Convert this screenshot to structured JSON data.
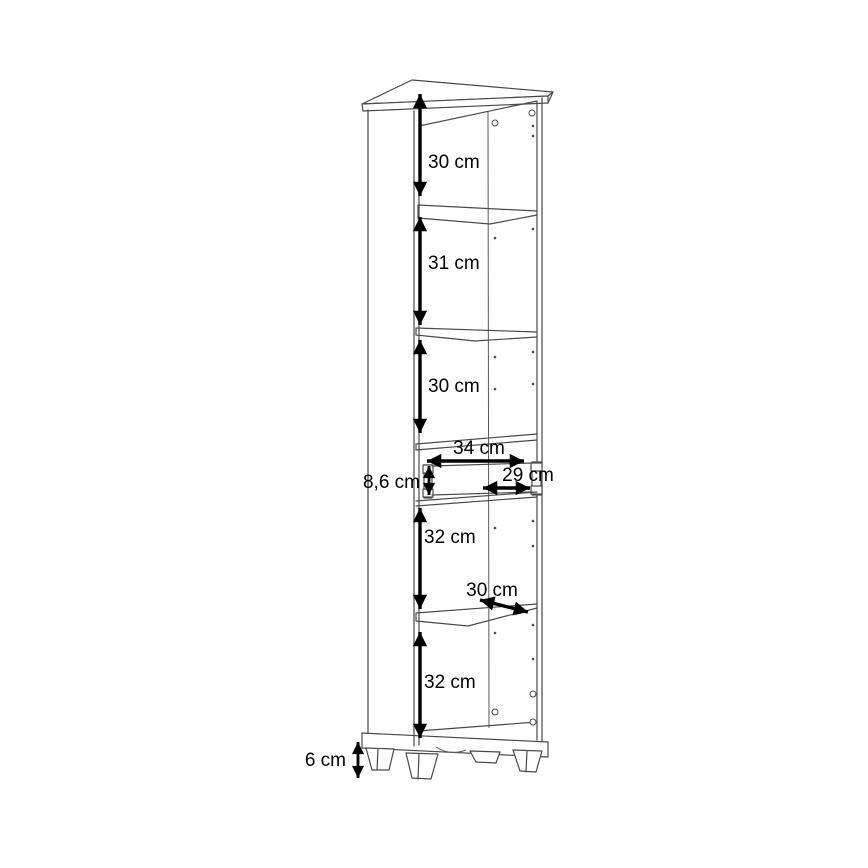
{
  "drawing": {
    "type": "furniture dimension diagram",
    "subject": "tall narrow cabinet with open shelves and one drawer on feet",
    "unit": "cm",
    "background_color": "#ffffff",
    "line_color": "#4a4a4a",
    "dimension_color": "#000000"
  },
  "dims": {
    "top_compartment": "30 cm",
    "second_compartment": "31 cm",
    "third_compartment": "30 cm",
    "niche_width": "34 cm",
    "drawer_front_height": "8,6 cm",
    "drawer_inner_width": "29 cm",
    "fourth_compartment": "32 cm",
    "shelf_depth": "30 cm",
    "bottom_compartment": "32 cm",
    "feet_height": "6 cm"
  },
  "cabinet": {
    "compartment_heights_cm": [
      30,
      31,
      30,
      32,
      32
    ],
    "drawer_niche_width_cm": 34,
    "drawer_front_height_cm": 8.6,
    "drawer_inner_width_cm": 29,
    "shelf_depth_cm": 30,
    "feet_height_cm": 6
  }
}
